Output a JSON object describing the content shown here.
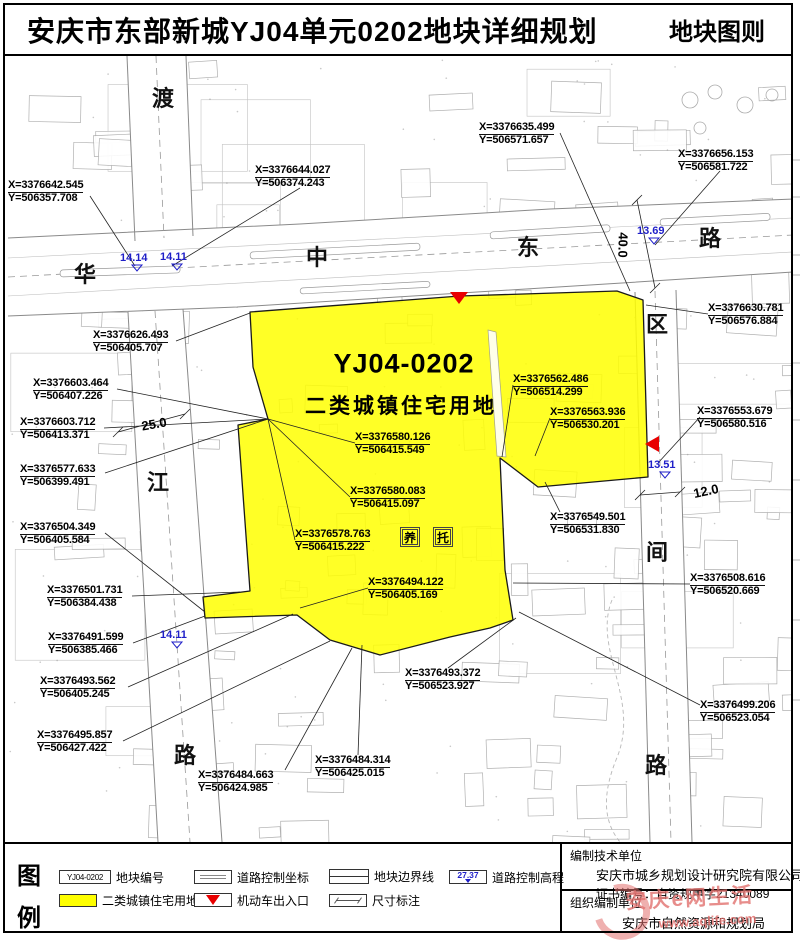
{
  "header": {
    "title": "安庆市东部新城YJ04单元0202地块详细规划",
    "sheet_label": "地块图则"
  },
  "plot": {
    "code": "YJ04-0202",
    "land_use": "二类城镇住宅用地",
    "care_boxes": [
      {
        "char": "养",
        "x": 410,
        "y": 537
      },
      {
        "char": "托",
        "x": 443,
        "y": 537
      }
    ]
  },
  "road_name_chars": [
    {
      "char": "渡",
      "x": 163,
      "y": 97
    },
    {
      "char": "华",
      "x": 85,
      "y": 273
    },
    {
      "char": "中",
      "x": 317,
      "y": 256
    },
    {
      "char": "东",
      "x": 528,
      "y": 246
    },
    {
      "char": "路",
      "x": 710,
      "y": 237
    },
    {
      "char": "江",
      "x": 158,
      "y": 481
    },
    {
      "char": "路",
      "x": 185,
      "y": 754
    },
    {
      "char": "区",
      "x": 657,
      "y": 323
    },
    {
      "char": "间",
      "x": 657,
      "y": 551
    },
    {
      "char": "路",
      "x": 656,
      "y": 764
    }
  ],
  "coordinate_labels": [
    {
      "x": 8,
      "y": 180,
      "xv": "X=3376642.545",
      "yv": "Y=506357.708",
      "leader": [
        90,
        196,
        135,
        266
      ]
    },
    {
      "x": 255,
      "y": 165,
      "xv": "X=3376644.027",
      "yv": "Y=506374.243",
      "leader": [
        300,
        188,
        172,
        266
      ]
    },
    {
      "x": 479,
      "y": 122,
      "xv": "X=3376635.499",
      "yv": "Y=506571.657",
      "leader": [
        560,
        133,
        630,
        291
      ]
    },
    {
      "x": 678,
      "y": 149,
      "xv": "X=3376656.153",
      "yv": "Y=506581.722",
      "leader": [
        720,
        171,
        655,
        245
      ]
    },
    {
      "x": 708,
      "y": 303,
      "xv": "X=3376630.781",
      "yv": "Y=506576.884",
      "leader": [
        708,
        314,
        646,
        305
      ]
    },
    {
      "x": 93,
      "y": 330,
      "xv": "X=3376626.493",
      "yv": "Y=506405.707",
      "leader": [
        176,
        341,
        250,
        313
      ]
    },
    {
      "x": 33,
      "y": 378,
      "xv": "X=3376603.464",
      "yv": "Y=506407.226",
      "leader": [
        117,
        389,
        268,
        419
      ]
    },
    {
      "x": 20,
      "y": 417,
      "xv": "X=3376603.712",
      "yv": "Y=506413.371",
      "leader": [
        104,
        428,
        268,
        419
      ]
    },
    {
      "x": 20,
      "y": 464,
      "xv": "X=3376577.633",
      "yv": "Y=506399.491",
      "leader": [
        105,
        473,
        268,
        419
      ]
    },
    {
      "x": 20,
      "y": 522,
      "xv": "X=3376504.349",
      "yv": "Y=506405.584",
      "leader": [
        105,
        533,
        205,
        612
      ]
    },
    {
      "x": 513,
      "y": 374,
      "xv": "X=3376562.486",
      "yv": "Y=506514.299",
      "leader": [
        513,
        385,
        502,
        457
      ]
    },
    {
      "x": 550,
      "y": 407,
      "xv": "X=3376563.936",
      "yv": "Y=506530.201",
      "leader": [
        550,
        418,
        535,
        456
      ]
    },
    {
      "x": 697,
      "y": 406,
      "xv": "X=3376553.679",
      "yv": "Y=506580.516",
      "leader": [
        700,
        417,
        658,
        463
      ]
    },
    {
      "x": 355,
      "y": 432,
      "xv": "X=3376580.126",
      "yv": "Y=506415.549",
      "leader": [
        355,
        443,
        268,
        419
      ]
    },
    {
      "x": 350,
      "y": 486,
      "xv": "X=3376580.083",
      "yv": "Y=506415.097",
      "leader": [
        350,
        497,
        268,
        419
      ]
    },
    {
      "x": 295,
      "y": 529,
      "xv": "X=3376578.763",
      "yv": "Y=506415.222",
      "leader": [
        295,
        540,
        268,
        419
      ]
    },
    {
      "x": 550,
      "y": 512,
      "xv": "X=3376549.501",
      "yv": "Y=506531.830",
      "leader": [
        560,
        512,
        545,
        482
      ]
    },
    {
      "x": 690,
      "y": 573,
      "xv": "X=3376508.616",
      "yv": "Y=506520.669",
      "leader": [
        690,
        584,
        513,
        583
      ]
    },
    {
      "x": 368,
      "y": 577,
      "xv": "X=3376494.122",
      "yv": "Y=506405.169",
      "leader": [
        368,
        588,
        300,
        608
      ]
    },
    {
      "x": 47,
      "y": 585,
      "xv": "X=3376501.731",
      "yv": "Y=506384.438",
      "leader": [
        132,
        596,
        240,
        592
      ]
    },
    {
      "x": 48,
      "y": 632,
      "xv": "X=3376491.599",
      "yv": "Y=506385.466",
      "leader": [
        133,
        643,
        205,
        616
      ]
    },
    {
      "x": 40,
      "y": 676,
      "xv": "X=3376493.562",
      "yv": "Y=506405.245",
      "leader": [
        128,
        687,
        293,
        614
      ]
    },
    {
      "x": 37,
      "y": 730,
      "xv": "X=3376495.857",
      "yv": "Y=506427.422",
      "leader": [
        123,
        741,
        330,
        641
      ]
    },
    {
      "x": 405,
      "y": 668,
      "xv": "X=3376493.372",
      "yv": "Y=506523.927",
      "leader": [
        448,
        668,
        516,
        618
      ]
    },
    {
      "x": 700,
      "y": 700,
      "xv": "X=3376499.206",
      "yv": "Y=506523.054",
      "leader": [
        700,
        705,
        519,
        612
      ]
    },
    {
      "x": 198,
      "y": 770,
      "xv": "X=3376484.663",
      "yv": "Y=506424.985",
      "leader": [
        285,
        770,
        352,
        648
      ]
    },
    {
      "x": 315,
      "y": 755,
      "xv": "X=3376484.314",
      "yv": "Y=506425.015",
      "leader": [
        358,
        755,
        362,
        645
      ]
    }
  ],
  "elevation_markers": [
    {
      "value": "14.14",
      "x": 120,
      "y": 252
    },
    {
      "value": "14.11",
      "x": 160,
      "y": 251
    },
    {
      "value": "13.69",
      "x": 637,
      "y": 225
    },
    {
      "value": "13.51",
      "x": 648,
      "y": 459
    },
    {
      "value": "14.11",
      "x": 160,
      "y": 629
    }
  ],
  "dimension_labels": [
    {
      "value": "25.0",
      "x": 154,
      "y": 424,
      "rot": -10
    },
    {
      "value": "40.0",
      "x": 623,
      "y": 245,
      "rot": 91
    },
    {
      "value": "12.0",
      "x": 706,
      "y": 491,
      "rot": -12
    }
  ],
  "entrance_markers": [
    {
      "dir": "down",
      "x": 459,
      "y": 297
    },
    {
      "dir": "left",
      "x": 652,
      "y": 444
    }
  ],
  "legend": {
    "title_chars": [
      "图",
      "例"
    ],
    "items": [
      {
        "x": 59,
        "y": 869,
        "type": "code-box",
        "swatch_text": "YJ04-0202",
        "label": "地块编号"
      },
      {
        "x": 194,
        "y": 869,
        "type": "coord-box",
        "label": "道路控制坐标"
      },
      {
        "x": 329,
        "y": 868,
        "type": "boundary-line",
        "label": "地块边界线"
      },
      {
        "x": 449,
        "y": 869,
        "type": "elevation-box",
        "swatch_text": "27.37",
        "label": "道路控制高程"
      },
      {
        "x": 59,
        "y": 892,
        "type": "landuse-fill",
        "label": "二类城镇住宅用地"
      },
      {
        "x": 194,
        "y": 892,
        "type": "entrance",
        "label": "机动车出入口"
      },
      {
        "x": 329,
        "y": 892,
        "type": "dimension",
        "label": "尺寸标注"
      }
    ]
  },
  "credits": {
    "tech_unit_label": "编制技术单位",
    "tech_unit_name": "安庆市城乡规划设计研究院有限公司",
    "cert_no": "证书编号：自资规甲字21340089",
    "org_unit_label": "组织编制单位",
    "org_unit_name": "安庆市自然资源和规划局"
  },
  "watermark": {
    "site_name": "安庆e网生活",
    "site_url": "www.aqlife.com"
  },
  "colors": {
    "plot_yellow": "#ffff00",
    "elevation_blue": "#1f1fc8",
    "entrance_red": "#e80000",
    "watermark_red": "#e2716f"
  }
}
